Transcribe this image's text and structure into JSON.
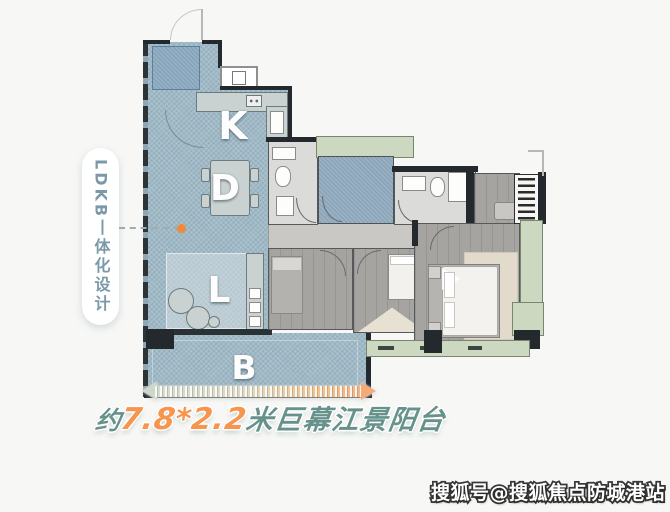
{
  "callout": {
    "label": "LDKB丨体化设计",
    "text_color": "#7c99a9"
  },
  "plan": {
    "room_labels": {
      "kitchen": "K",
      "dining": "D",
      "living": "L",
      "balcony": "B"
    },
    "colors": {
      "ldkb_zone": "#a0b9c6",
      "green_platform": "#ccd8c0",
      "blue_room_floor": "#8ba6bb",
      "room_floor": "#a6a4a1",
      "wall": "#23292d",
      "accent_orange": "#f08a39"
    }
  },
  "dimension_caption": {
    "prefix": "约",
    "value": "7.8*2.2",
    "suffix": "米巨幕江景阳台",
    "teal": "#67928b",
    "orange": "#f6954d"
  },
  "watermark": {
    "text": "搜狐号@搜狐焦点防城港站"
  }
}
